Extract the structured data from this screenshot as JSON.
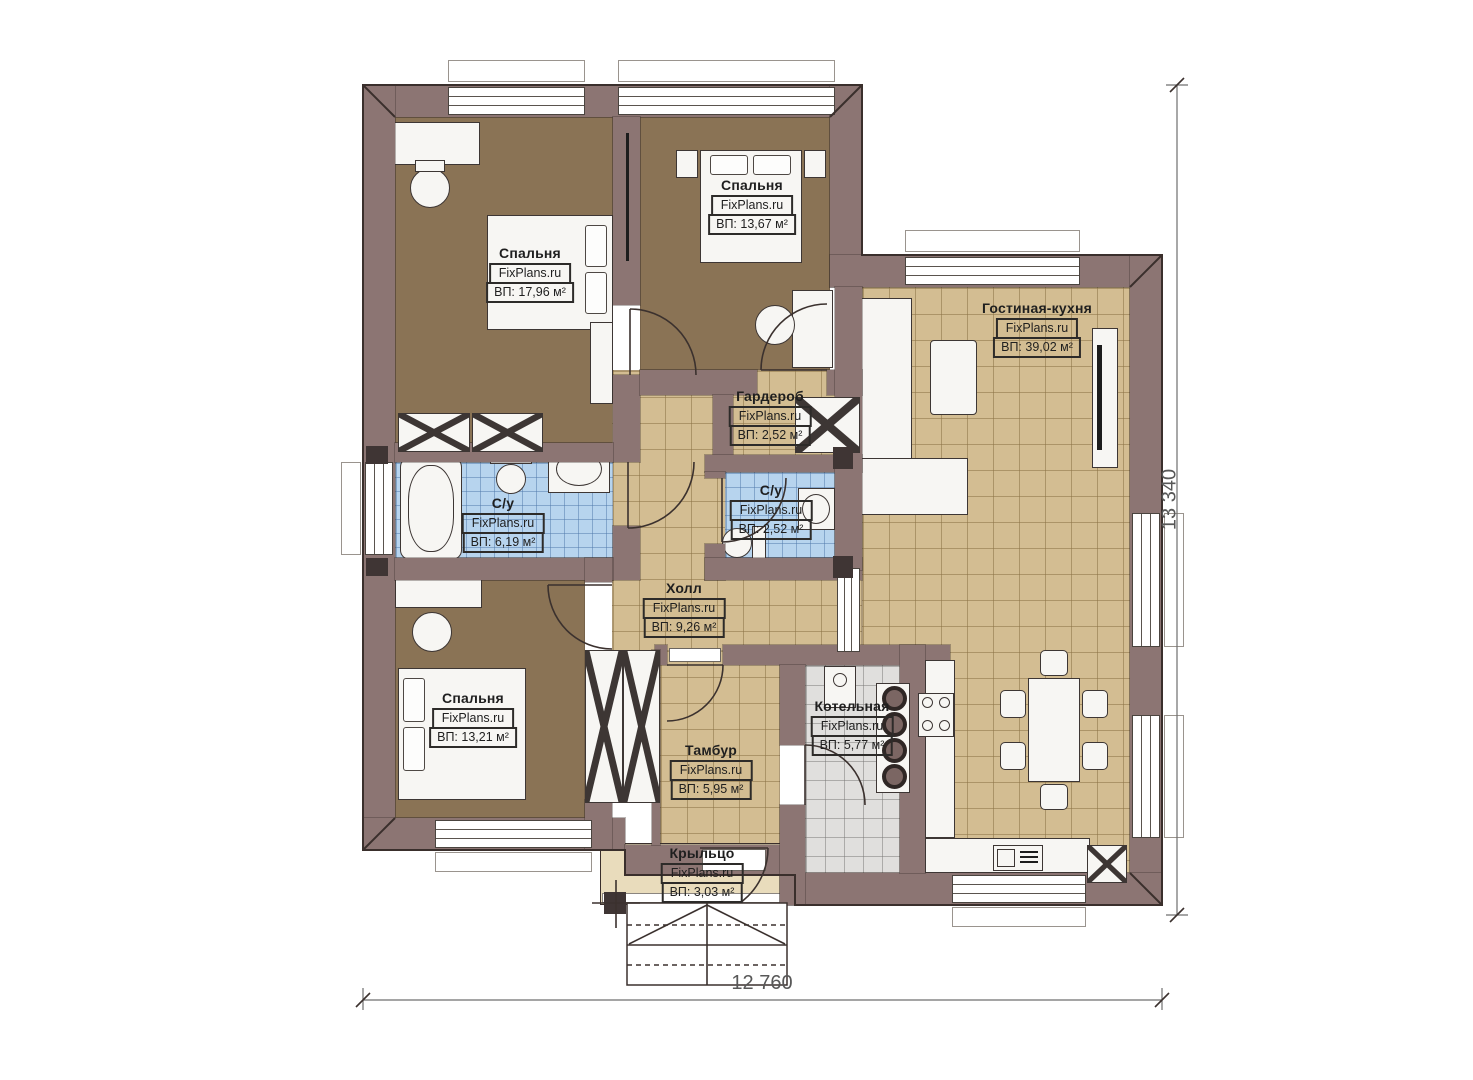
{
  "plan": {
    "brand": "FixPlans.ru",
    "rooms": [
      {
        "id": "bedroom-1",
        "name": "Спальня",
        "area": "ВП: 17,96 м²"
      },
      {
        "id": "bedroom-2",
        "name": "Спальня",
        "area": "ВП: 13,67 м²"
      },
      {
        "id": "living-kitchen",
        "name": "Гостиная-кухня",
        "area": "ВП: 39,02 м²"
      },
      {
        "id": "wardrobe",
        "name": "Гардероб",
        "area": "ВП: 2,52 м²"
      },
      {
        "id": "bathroom-1",
        "name": "С/у",
        "area": "ВП: 6,19 м²"
      },
      {
        "id": "bathroom-2",
        "name": "С/у",
        "area": "ВП: 2,52 м²"
      },
      {
        "id": "hall",
        "name": "Холл",
        "area": "ВП: 9,26 м²"
      },
      {
        "id": "bedroom-3",
        "name": "Спальня",
        "area": "ВП: 13,21 м²"
      },
      {
        "id": "boiler-room",
        "name": "Котельная",
        "area": "ВП: 5,77 м²"
      },
      {
        "id": "vestibule",
        "name": "Тамбур",
        "area": "ВП: 5,95 м²"
      },
      {
        "id": "porch",
        "name": "Крыльцо",
        "area": "ВП: 3,03 м²"
      }
    ],
    "dimensions": {
      "bottom": "12 760",
      "right": "13 340"
    },
    "colors": {
      "wall": "#8c7573",
      "bedroomFloor": "#8a7355",
      "tileBeige": "#d3bd92",
      "tileBlue": "#b7d4ee",
      "tileGrey": "#e0dfdd",
      "porch": "#e9dcbc"
    }
  }
}
